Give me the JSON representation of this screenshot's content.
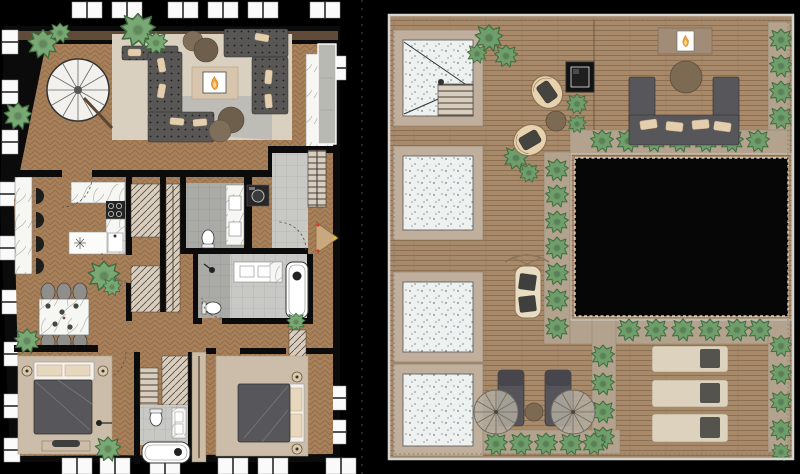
{
  "document": {
    "type": "architectural floor plan set",
    "sheets": [
      {
        "id": "apartment",
        "label": "Apartment level plan"
      },
      {
        "id": "roof",
        "label": "Roof terrace plan"
      }
    ]
  },
  "colors": {
    "background": "#000000",
    "wall": "#0b0b0b",
    "window": "#fafafa",
    "wood": "#a8805a",
    "wood_line": "#7e5c3e",
    "deck": "#a8896a",
    "deck_line": "#8b6f52",
    "planter": "#b3a28d",
    "rug_beige": "#d9d0c0",
    "rug_gray": "#bdbcb7",
    "bedroom_rug": "#cbbda9",
    "sofa": "#585755",
    "pillow": "#e3cfae",
    "pouf": "#7e6e5a",
    "marble": "#f6f6f3",
    "tile": "#c8c8c5",
    "tile_dark": "#aaaaa7",
    "hatch_bg": "#d8cec0",
    "hatch_line": "#5f5040",
    "plant_indoor": "#79a874",
    "plant_outdoor": "#6f9e6b",
    "flame": "#f0a03a",
    "skylight_frame": "#c0af9d",
    "glass": "#edf1f0",
    "void": "#060606",
    "rail": "#f2f2ee",
    "wicker": "#e8d2ae",
    "outdoor_sofa": "#57565a",
    "lounger_dark": "#54545a",
    "lounger_beige": "#dcd2bd",
    "umbrella": "#b5afa3",
    "table_wood": "#7d6a52",
    "fire_table": "#121212",
    "landing": "#c9a87e"
  },
  "apartment": {
    "rooms": [
      "living-room",
      "kitchen",
      "dining-area",
      "hallway-wardrobes",
      "bathroom-1",
      "bathroom-2",
      "shower-room",
      "entry-vestibule",
      "bedroom-1",
      "ensuite-bathroom",
      "bedroom-2"
    ],
    "living_room_items": [
      "spiral-staircase",
      "sectional-sofas",
      "fireplace-table",
      "beige-rug",
      "gray-rug",
      "ottomans",
      "marble-feature-wall",
      "plants"
    ],
    "kitchen_items": [
      "marble-island",
      "four-bar-stools",
      "cooktop",
      "sink",
      "counters",
      "plant"
    ],
    "dining_items": [
      "marble-table",
      "six-chairs",
      "plants"
    ],
    "bedroom_items": [
      "double-bed",
      "nightstand-lamps",
      "bench",
      "wardrobes",
      "rug"
    ],
    "bath_items": [
      "toilet",
      "vanity-sinks",
      "bathtub",
      "shower",
      "washer"
    ],
    "entry_items": [
      "tiled-floor",
      "access-stair",
      "landing-triangle",
      "door-swing"
    ],
    "window_counts": {
      "top": 6,
      "left": 9,
      "bottom": 6,
      "right": 3
    }
  },
  "roof_terrace": {
    "features": [
      "wood-decking",
      "four-skylights",
      "stair-access-skylight",
      "central-void-opening",
      "perimeter-railing",
      "planter-hedges",
      "outdoor-fireplace",
      "fire-table",
      "u-shaped-lounge-sofa",
      "round-coffee-table",
      "two-wicker-chairs",
      "canopy-daybed",
      "sun-loungers",
      "parasols"
    ],
    "skylights": 4,
    "parasols": 2,
    "sun_loungers_dark": 2,
    "sun_loungers_beige": 3,
    "wicker_chairs": 2
  }
}
